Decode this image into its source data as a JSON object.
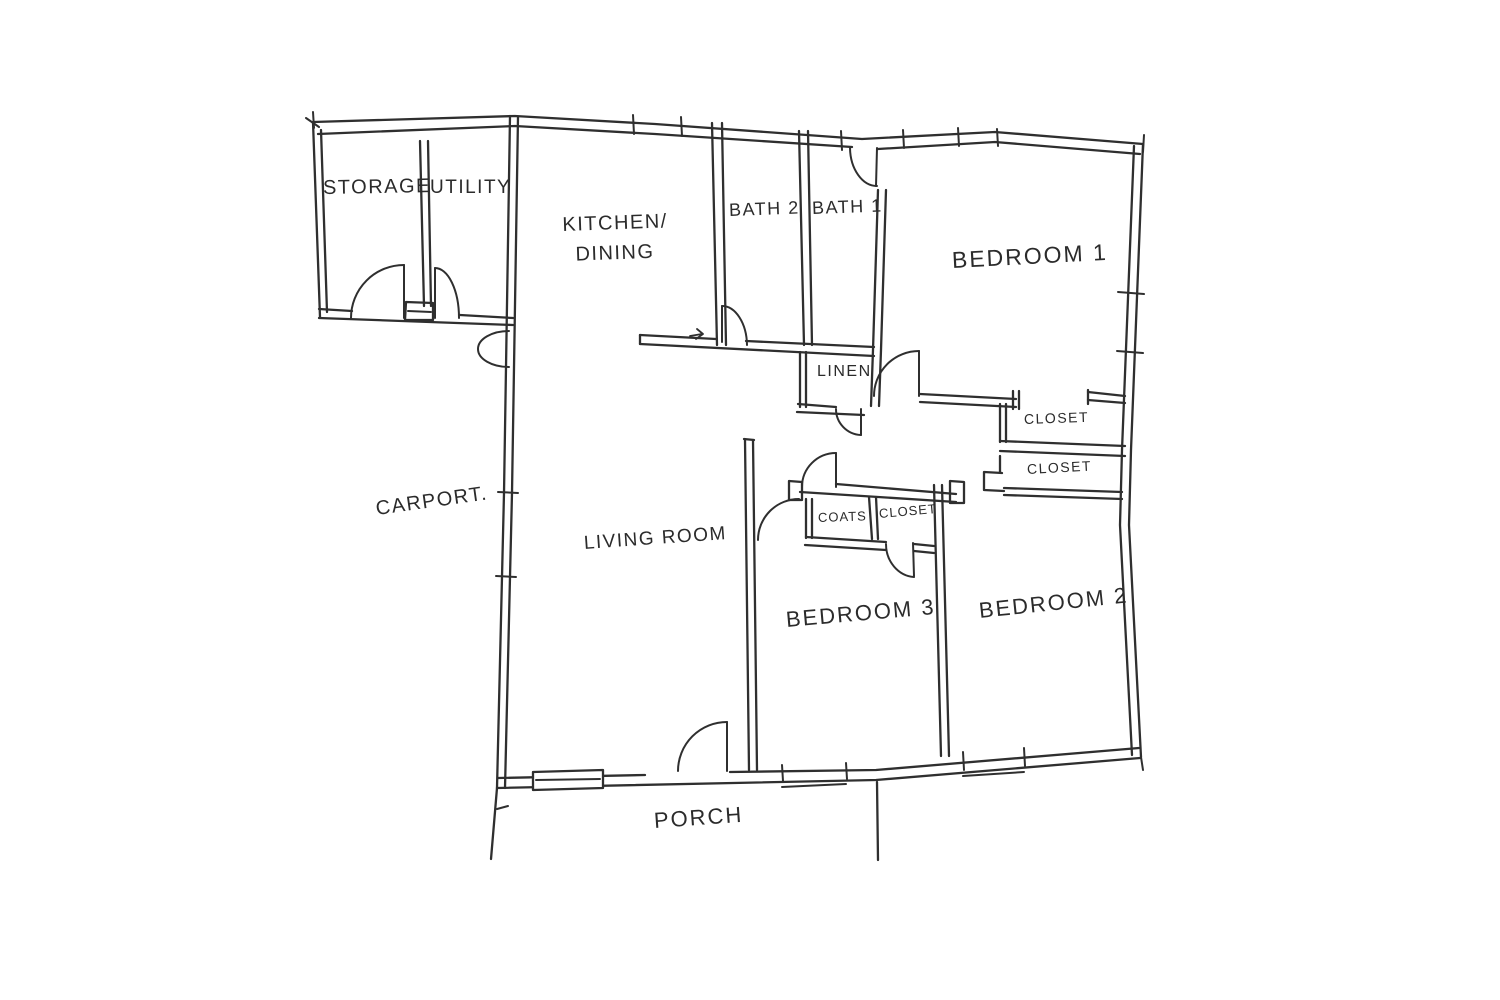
{
  "colors": {
    "ink": "#2f2f2f",
    "paper": "#ffffff"
  },
  "rooms": {
    "storage": {
      "label": "STORAGE"
    },
    "utility": {
      "label": "UTILITY"
    },
    "kitchen_dining": {
      "line1": "KITCHEN/",
      "line2": "DINING"
    },
    "bath2": {
      "label": "BATH 2"
    },
    "bath1": {
      "label": "BATH 1"
    },
    "bedroom1": {
      "label": "BEDROOM 1"
    },
    "linen": {
      "label": "LINEN"
    },
    "closet_top": {
      "label": "CLOSET"
    },
    "closet_bottom": {
      "label": "CLOSET"
    },
    "carport": {
      "label": "CARPORT."
    },
    "living_room": {
      "label": "LIVING ROOM"
    },
    "coats": {
      "label": "COATS"
    },
    "closet_hall": {
      "label": "CLOSET"
    },
    "bedroom3": {
      "label": "BEDROOM 3"
    },
    "bedroom2": {
      "label": "BEDROOM 2"
    },
    "porch": {
      "label": "PORCH"
    }
  }
}
